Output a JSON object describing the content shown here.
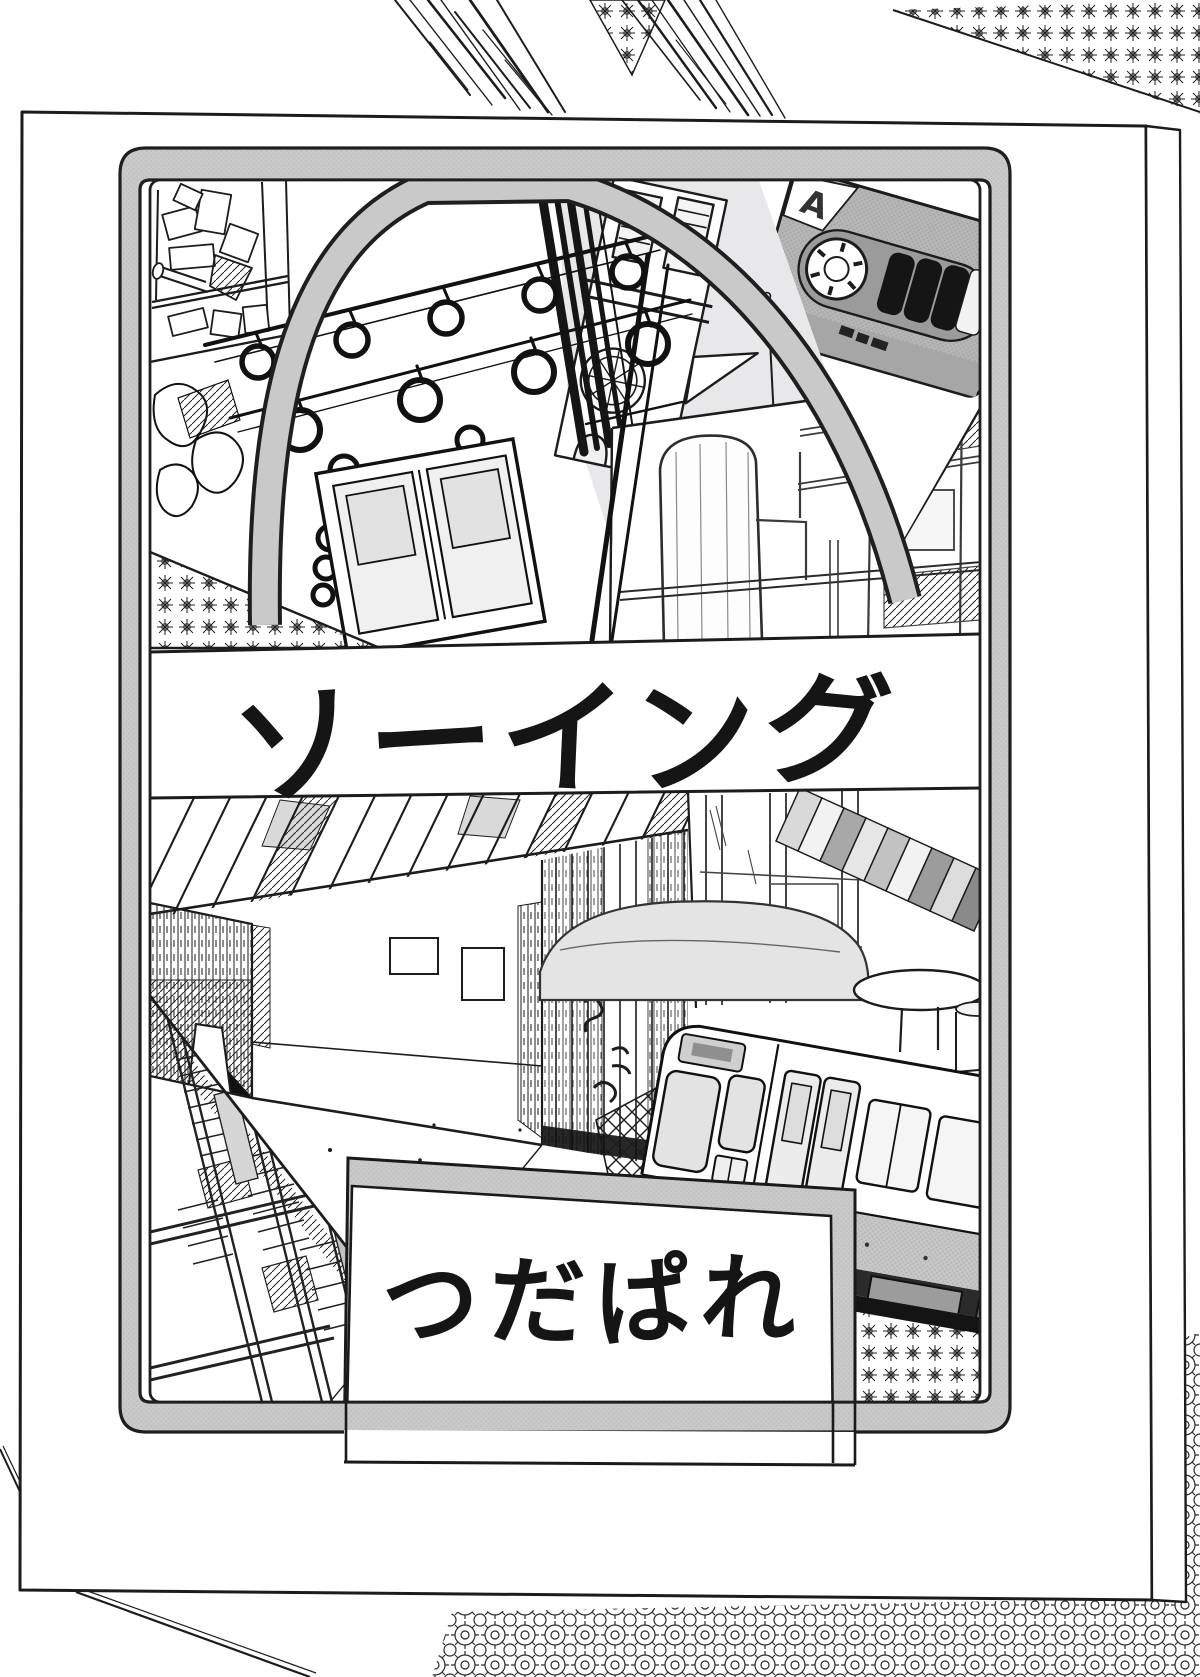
{
  "cover": {
    "title": "ソーイング",
    "author": "つだぱれ",
    "cassette_side_label": "A"
  },
  "artwork": {
    "type": "monochrome manga cover collage",
    "panels": [
      "cluttered-shelf",
      "train-interior-hanging-straps",
      "church-bell-tower",
      "cassette-tape",
      "factory-tank-room",
      "star-pattern-triangle",
      "back-alley",
      "room-with-window-and-table",
      "bookshelf-spines",
      "commuter-train-car",
      "train-bogie-over-star-pattern"
    ]
  },
  "colors": {
    "paper": "#ffffff",
    "ink": "#1c1c1c",
    "frame_gray": "#c9c9c9",
    "sky_gray": "#e8e8ea",
    "mid_gray": "#b5b5b5",
    "title_ink": "#151515"
  }
}
